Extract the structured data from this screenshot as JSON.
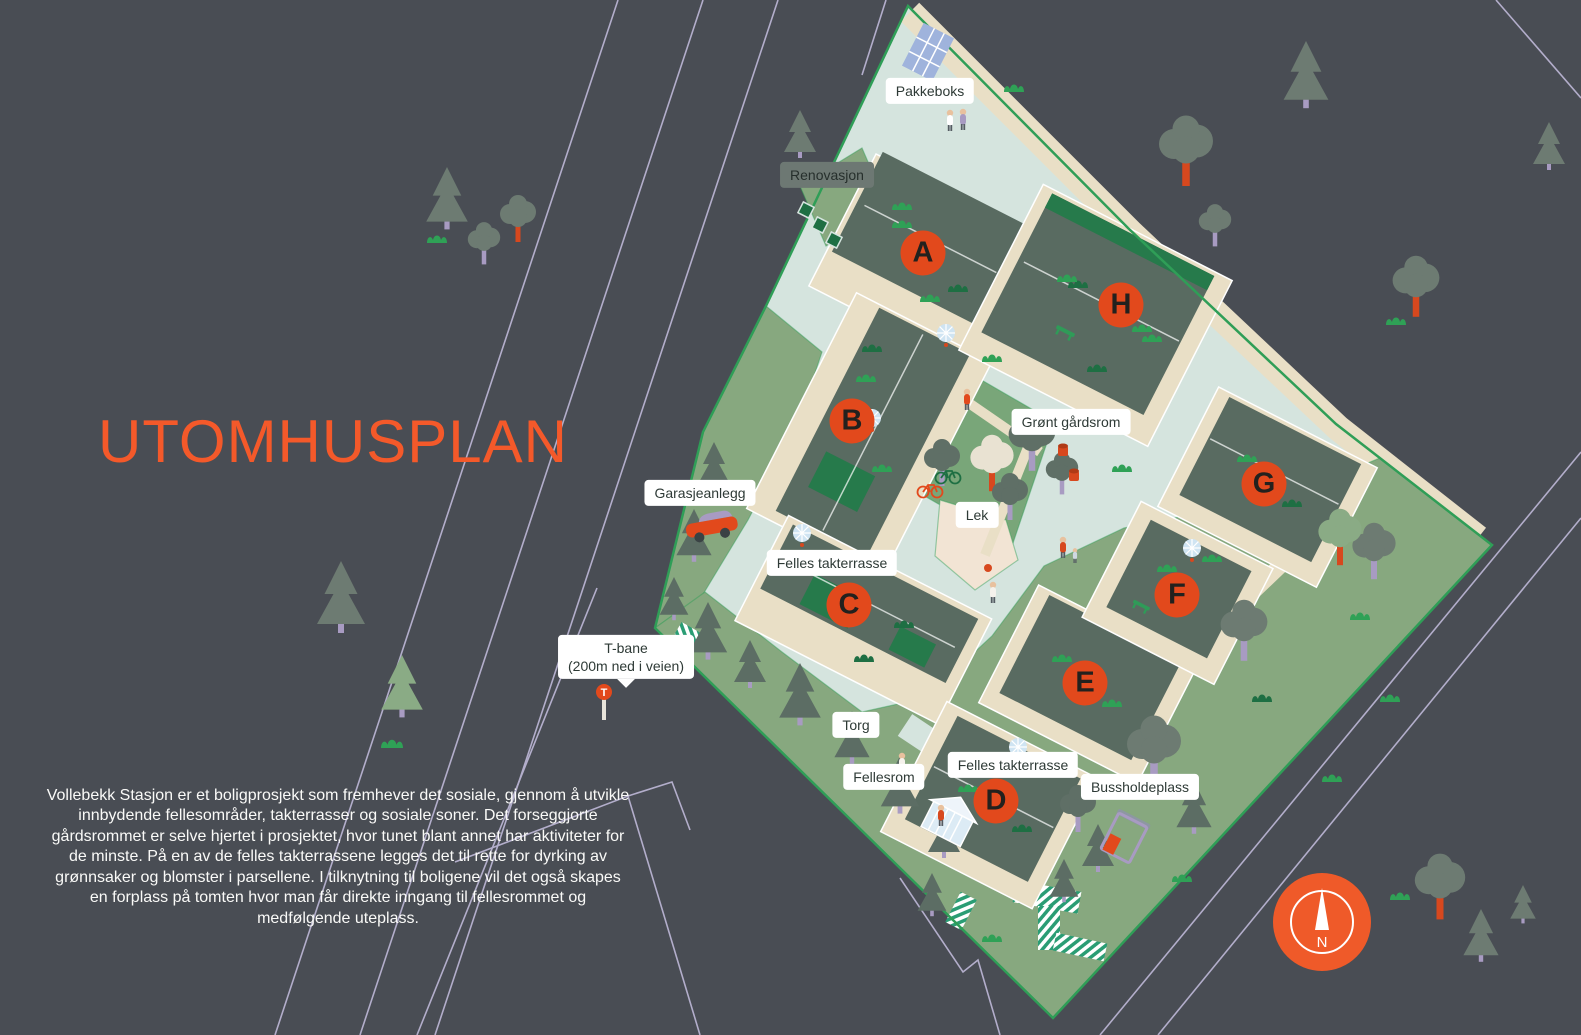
{
  "page": {
    "background_color": "#494d54"
  },
  "header": {
    "title": "UTOMHUSPLAN",
    "title_color": "#f4592a"
  },
  "description": {
    "text": "Vollebekk Stasjon er et boligprosjekt som fremhever det sosiale, gjennom å utvikle innbydende fellesområder, takterrasser og sosiale soner. Det forseggjorte gårdsrommet er selve hjertet i prosjektet, hvor tunet blant annet har aktiviteter for de minste. På en av de felles takterrassene legges det til rette for dyrking av grønnsaker og blomster i parsellene. I tilknytning til boligene vil det også skapes en forplass på tomten hvor man får direkte inngang til fellesrommet og medfølgende uteplass."
  },
  "map": {
    "building_markers": [
      {
        "label": "A",
        "x": 923,
        "y": 253
      },
      {
        "label": "B",
        "x": 852,
        "y": 421
      },
      {
        "label": "C",
        "x": 849,
        "y": 605
      },
      {
        "label": "D",
        "x": 996,
        "y": 801
      },
      {
        "label": "E",
        "x": 1085,
        "y": 683
      },
      {
        "label": "F",
        "x": 1177,
        "y": 595
      },
      {
        "label": "G",
        "x": 1264,
        "y": 484
      },
      {
        "label": "H",
        "x": 1121,
        "y": 305
      }
    ],
    "area_labels": [
      {
        "text": "Pakkeboks",
        "x": 930,
        "y": 91,
        "style": "light"
      },
      {
        "text": "Renovasjon",
        "x": 827,
        "y": 175,
        "style": "dark"
      },
      {
        "text": "Grønt gårdsrom",
        "x": 1071,
        "y": 422,
        "style": "light"
      },
      {
        "text": "Garasjeanlegg",
        "x": 700,
        "y": 493,
        "style": "light"
      },
      {
        "text": "Lek",
        "x": 977,
        "y": 515,
        "style": "light"
      },
      {
        "text": "Felles takterrasse",
        "x": 832,
        "y": 563,
        "style": "light"
      },
      {
        "lines": [
          "T-bane",
          "(200m ned i veien)"
        ],
        "x": 626,
        "y": 657,
        "style": "pointer"
      },
      {
        "text": "Torg",
        "x": 856,
        "y": 725,
        "style": "light"
      },
      {
        "text": "Fellesrom",
        "x": 884,
        "y": 777,
        "style": "light"
      },
      {
        "text": "Felles takterrasse",
        "x": 1013,
        "y": 765,
        "style": "light"
      },
      {
        "text": "Bussholdeplass",
        "x": 1140,
        "y": 787,
        "style": "light"
      }
    ],
    "compass": {
      "label": "N",
      "x": 1322,
      "y": 922
    },
    "colors": {
      "marker_orange": "#e2491c",
      "site_mint": "#d5e4de",
      "park_green": "#87a87f",
      "roof_green": "#596b61",
      "terrace_beige": "#e9dfc6",
      "border_green": "#2f9e57",
      "road_line_lavender": "#b3aecb"
    }
  }
}
